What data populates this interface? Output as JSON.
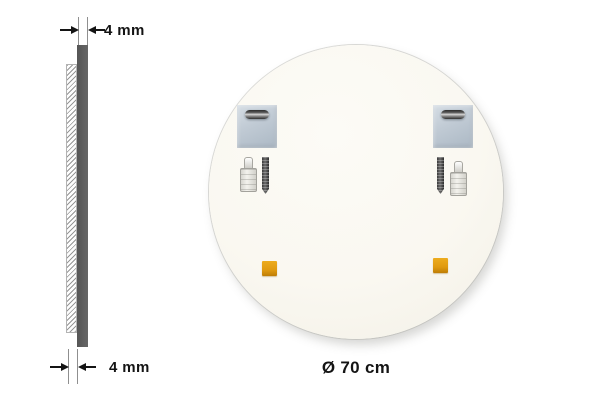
{
  "page": {
    "type": "mirror-product-dimension-diagram",
    "background": "#ffffff"
  },
  "side_view": {
    "top_dimension": {
      "label": "4 mm"
    },
    "bottom_dimension": {
      "label": "4 mm"
    }
  },
  "mirror_back": {
    "diameter_label": "Ø 70 cm",
    "parts": {
      "mounting_plates": "square keyhole mounting plate",
      "wall_plugs": "wall plug with screw",
      "screws": "dark metal screw",
      "pads": "orange adhesive pad"
    }
  },
  "colors": {
    "glass_edge_bar": "#5d5d5d",
    "mirror_back_fill": "#faf8f1",
    "bracket_metal": "#c3cdd6",
    "adhesive_pad": "#e09a10",
    "dimension_ink": "#141414"
  }
}
